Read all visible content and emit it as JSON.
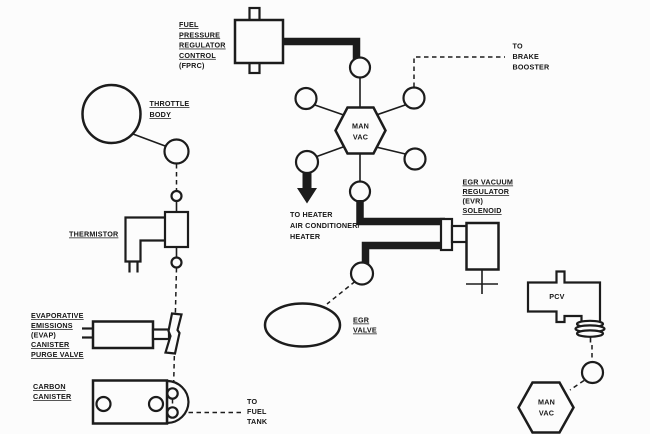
{
  "diagram": {
    "type": "engine-vacuum-hose-routing-diagram",
    "ink_color": "#1c1c1c",
    "background_color": "#fcfcfc"
  },
  "labels": {
    "fprc": {
      "lines": [
        "FUEL",
        "PRESSURE",
        "REGULATOR",
        "CONTROL",
        "(FPRC)"
      ]
    },
    "throttle_body": {
      "lines": [
        "THROTTLE",
        "BODY"
      ]
    },
    "thermistor": {
      "lines": [
        "THERMISTOR"
      ]
    },
    "evap": {
      "lines": [
        "EVAPORATIVE",
        "EMISSIONS",
        "(EVAP)",
        "CANISTER",
        "PURGE VALVE"
      ]
    },
    "carbon_canister": {
      "lines": [
        "CARBON",
        "CANISTER"
      ]
    },
    "egr_valve": {
      "lines": [
        "EGR",
        "VALVE"
      ]
    },
    "evr_solenoid": {
      "lines": [
        "EGR VACUUM",
        "REGULATOR",
        "(EVR)",
        "SOLENOID"
      ]
    },
    "to_brake_booster": {
      "lines": [
        "TO",
        "BRAKE",
        "BOOSTER"
      ]
    },
    "to_heater": {
      "lines": [
        "TO HEATER",
        "AIR CONDITIONER/",
        "HEATER"
      ]
    },
    "to_fuel_tank": {
      "lines": [
        "TO",
        "FUEL",
        "TANK"
      ]
    },
    "pcv": "PCV",
    "man_vac_center": {
      "lines": [
        "MAN",
        "VAC"
      ]
    },
    "man_vac_lower": {
      "lines": [
        "MAN",
        "VAC"
      ]
    }
  }
}
